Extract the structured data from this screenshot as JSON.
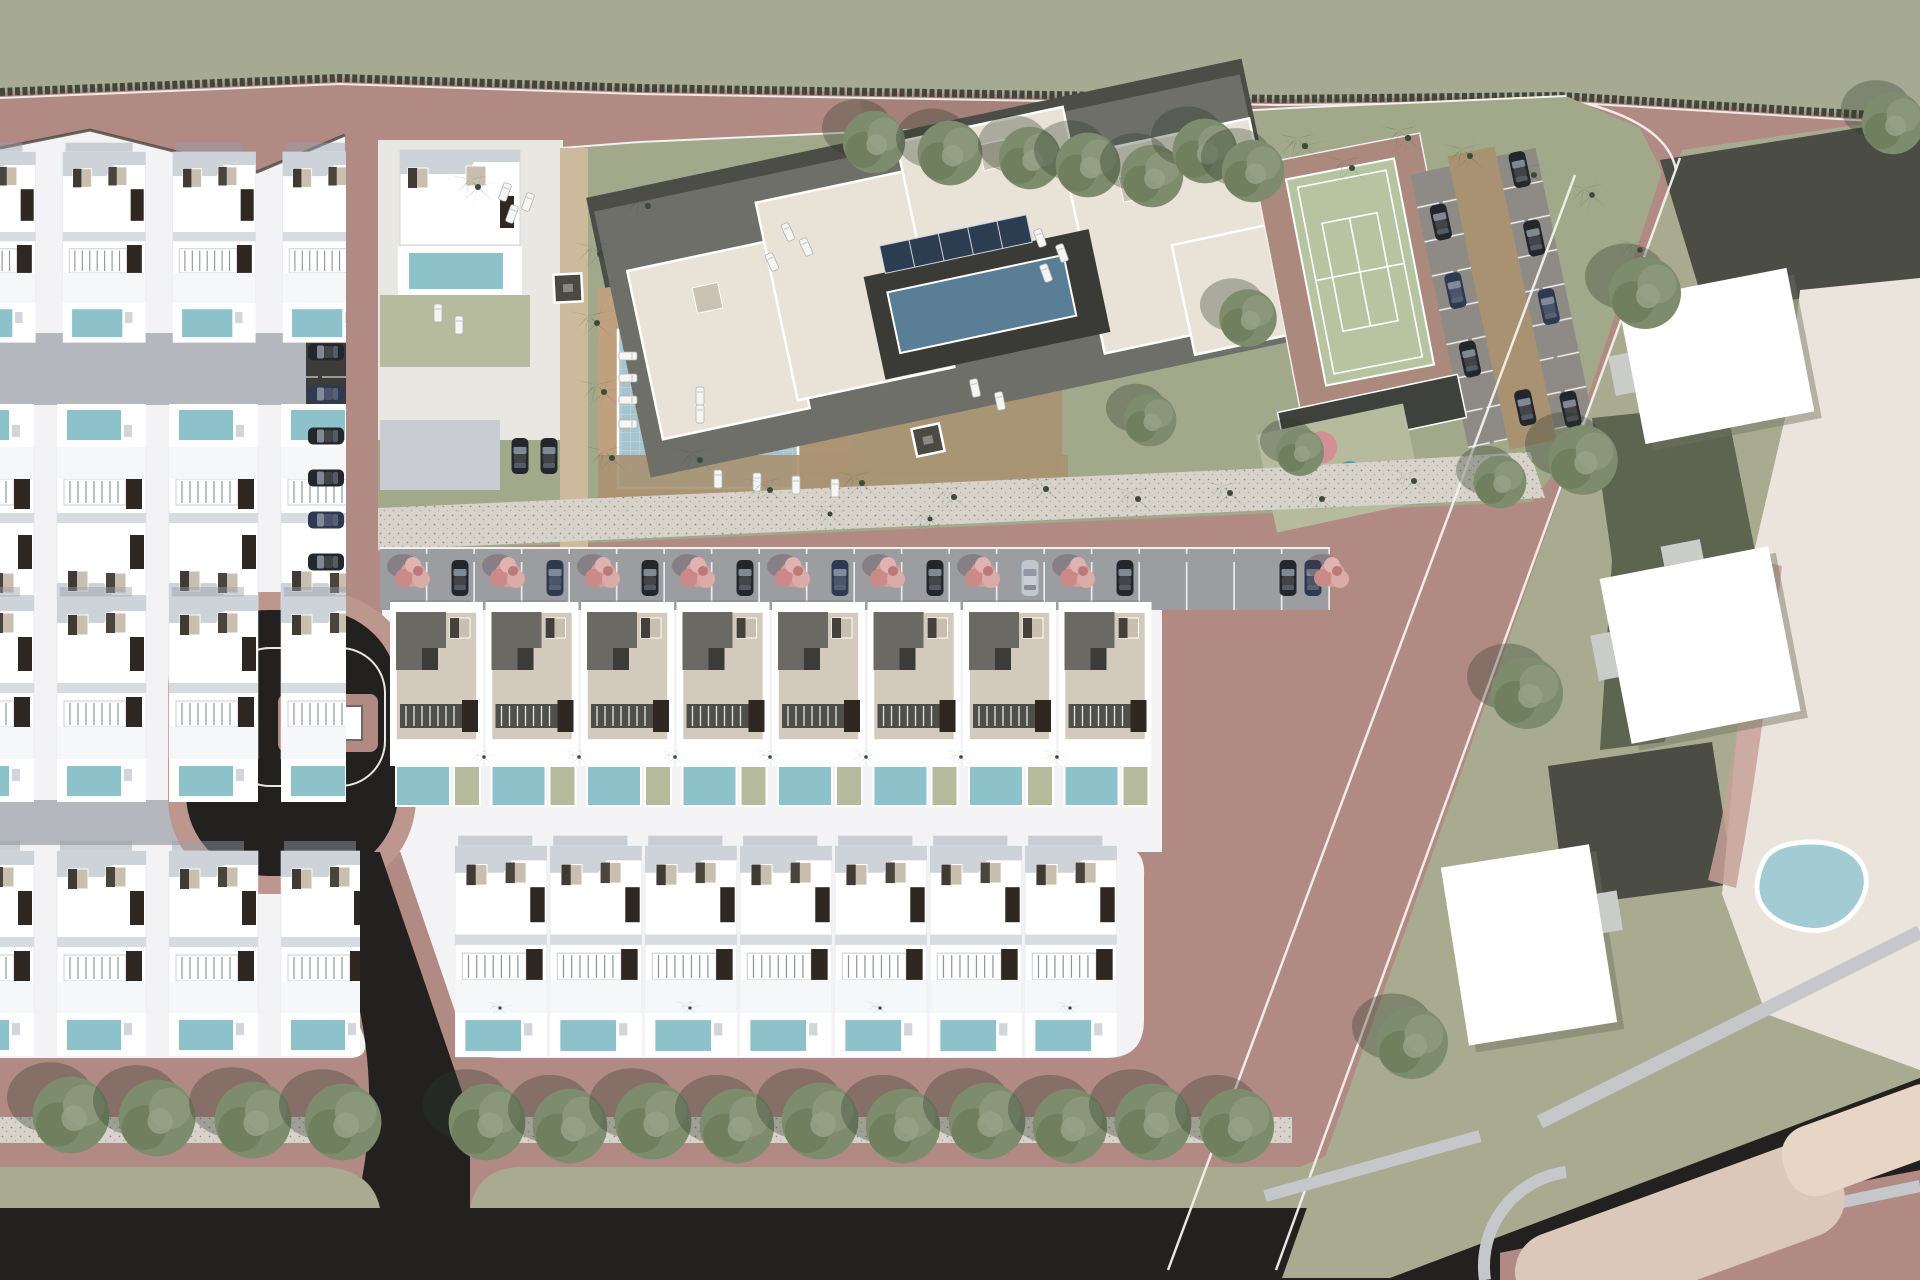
{
  "meta": {
    "title": "Residential development aerial site plan render",
    "render_type": "3D top-down masterplan",
    "visible_text": "none"
  },
  "palette": {
    "road": "#b18a84",
    "road_light": "#bd968e",
    "road_dark": "#a27d77",
    "greenbelt": "#a6aa92",
    "wall": "#41463a",
    "white_ground": "#f3f3f5",
    "driveway": "#b5b7be",
    "sidewalk": "#c6c7cb",
    "asphalt": "#222120",
    "dark_strip": "#3c3d3a",
    "stall_gray": "#8e8b86",
    "lawn_olive": "#a2a88a",
    "lawn_sage": "#a8ab90",
    "lawn_dark": "#5d6450",
    "sage_pad": "#b7bb9e",
    "pool": "#8ec2cb",
    "big_pool": "#a7c4ce",
    "apt_pool": "#5a7e95",
    "pond": "#a3cbd3",
    "deck_tan": "#bfa07f",
    "path_tan": "#a89272",
    "plaza_tan": "#c9b294",
    "gravel": "#d7d3ca",
    "roof_tan": "#d2cbbd",
    "roof_dark": "#5e5e5a",
    "tree": "#7e8c6e",
    "tree_dark": "#5c6b4f",
    "palm": "#57745a",
    "pink_tree": "#d49d9a",
    "car_dark": "#23262a",
    "car_navy": "#2e3952",
    "car_silver": "#c2c7cf",
    "garage_brown": "#2f2721",
    "window_beige": "#c8bfae",
    "cream": "#ebe4dd",
    "beige": "#dbc8ba",
    "dark_drive": "#4b4c44",
    "tennis": "#b7c4a2",
    "tennis_pad": "#ab8a7d",
    "apt_plate": "#6e6f68",
    "apt_dark": "#4c4d47",
    "apt_cream": "#e8e3d6",
    "courtyard": "#3a3b36",
    "solar": "#2c3d52",
    "play_pink": "#d48f96",
    "play_teal": "#4f97a8",
    "play_sand": "#d7b98a"
  },
  "scene": {
    "villa_rows": [
      {
        "x": -50,
        "y": 152,
        "n": 4,
        "dx": 110,
        "v": "a",
        "s": 0.93,
        "clip": "clipL"
      },
      {
        "x": -58,
        "y": 404,
        "n": 4,
        "dx": 112,
        "v": "b",
        "s": 1,
        "clip": "clipL"
      },
      {
        "x": -58,
        "y": 597,
        "n": 4,
        "dx": 112,
        "v": "a",
        "s": 1,
        "clip": "clipL"
      },
      {
        "x": -58,
        "y": 851,
        "n": 4,
        "dx": 112,
        "v": "a",
        "s": 1,
        "clip": "clipL3"
      },
      {
        "x": 452,
        "y": 846,
        "n": 7,
        "dx": 95,
        "v": "a",
        "s": 1.03
      }
    ],
    "townhouses": {
      "x": 388,
      "y": 608,
      "n": 8,
      "dx": 95.5
    },
    "trees": [
      [
        71,
        1115,
        1.6
      ],
      [
        157,
        1118,
        1.6
      ],
      [
        253,
        1120,
        1.6
      ],
      [
        343,
        1122,
        1.6
      ],
      [
        487,
        1122,
        1.6
      ],
      [
        570,
        1126,
        1.55
      ],
      [
        653,
        1121,
        1.6
      ],
      [
        737,
        1126,
        1.55
      ],
      [
        820,
        1121,
        1.6
      ],
      [
        903,
        1126,
        1.55
      ],
      [
        987,
        1121,
        1.6
      ],
      [
        1070,
        1126,
        1.55
      ],
      [
        1153,
        1122,
        1.6
      ],
      [
        1237,
        1126,
        1.55
      ],
      [
        874,
        142,
        1.3
      ],
      [
        950,
        153,
        1.35
      ],
      [
        1030,
        158,
        1.3
      ],
      [
        1088,
        165,
        1.35
      ],
      [
        1152,
        176,
        1.3
      ],
      [
        1205,
        151,
        1.35
      ],
      [
        1253,
        171,
        1.3
      ],
      [
        1645,
        293,
        1.5
      ],
      [
        1583,
        460,
        1.45
      ],
      [
        1527,
        693,
        1.5
      ],
      [
        1412,
        1043,
        1.5
      ],
      [
        1893,
        123,
        1.3
      ],
      [
        1248,
        318,
        1.2
      ],
      [
        1150,
        420,
        1.1
      ],
      [
        1500,
        482,
        1.1
      ],
      [
        1300,
        452,
        1.0
      ]
    ],
    "palms": [
      [
        600,
        254,
        1
      ],
      [
        597,
        323,
        1
      ],
      [
        604,
        392,
        1
      ],
      [
        612,
        458,
        1
      ],
      [
        648,
        206,
        1
      ],
      [
        478,
        187,
        1
      ],
      [
        700,
        460,
        1
      ],
      [
        770,
        490,
        1
      ],
      [
        862,
        483,
        1
      ],
      [
        954,
        497,
        1
      ],
      [
        1046,
        489,
        1
      ],
      [
        1138,
        499,
        1
      ],
      [
        1230,
        493,
        1
      ],
      [
        1322,
        499,
        1
      ],
      [
        1414,
        481,
        1
      ],
      [
        830,
        514,
        0.85
      ],
      [
        930,
        519,
        0.85
      ],
      [
        1305,
        146,
        1.05
      ],
      [
        1352,
        168,
        1
      ],
      [
        1408,
        138,
        1.05
      ],
      [
        1470,
        156,
        1
      ],
      [
        1534,
        175,
        1
      ],
      [
        1592,
        195,
        0.95
      ],
      [
        1640,
        250,
        0.9
      ],
      [
        484,
        757,
        0.6
      ],
      [
        579,
        757,
        0.6
      ],
      [
        675,
        757,
        0.6
      ],
      [
        770,
        757,
        0.6
      ],
      [
        866,
        757,
        0.6
      ],
      [
        961,
        757,
        0.6
      ],
      [
        1057,
        757,
        0.6
      ],
      [
        500,
        1008,
        0.55
      ],
      [
        690,
        1008,
        0.55
      ],
      [
        880,
        1008,
        0.55
      ],
      [
        1070,
        1008,
        0.55
      ]
    ],
    "pink_trees": [
      [
        413,
        574
      ],
      [
        508,
        574
      ],
      [
        603,
        574
      ],
      [
        698,
        574
      ],
      [
        793,
        574
      ],
      [
        888,
        574
      ],
      [
        983,
        574
      ],
      [
        1078,
        574
      ],
      [
        1332,
        574
      ]
    ],
    "cars": [
      {
        "x": 460,
        "y": 578,
        "r": 90,
        "c": "car_dark"
      },
      {
        "x": 555,
        "y": 578,
        "r": 90,
        "c": "car_navy"
      },
      {
        "x": 650,
        "y": 578,
        "r": 90,
        "c": "car_dark"
      },
      {
        "x": 745,
        "y": 578,
        "r": 90,
        "c": "car_dark"
      },
      {
        "x": 840,
        "y": 578,
        "r": 90,
        "c": "car_navy"
      },
      {
        "x": 935,
        "y": 578,
        "r": 90,
        "c": "car_dark"
      },
      {
        "x": 1030,
        "y": 578,
        "r": 90,
        "c": "car_silver"
      },
      {
        "x": 1125,
        "y": 578,
        "r": 90,
        "c": "car_dark"
      },
      {
        "x": 1288,
        "y": 578,
        "r": 90,
        "c": "car_dark"
      },
      {
        "x": 1313,
        "y": 578,
        "r": 90,
        "c": "car_navy"
      },
      {
        "x": 326,
        "y": 352,
        "r": 0,
        "c": "car_dark"
      },
      {
        "x": 326,
        "y": 394,
        "r": 0,
        "c": "car_navy"
      },
      {
        "x": 326,
        "y": 436,
        "r": 0,
        "c": "car_dark"
      },
      {
        "x": 326,
        "y": 478,
        "r": 0,
        "c": "car_dark"
      },
      {
        "x": 326,
        "y": 520,
        "r": 0,
        "c": "car_navy"
      },
      {
        "x": 326,
        "y": 562,
        "r": 0,
        "c": "car_dark"
      },
      {
        "x": 520,
        "y": 456,
        "r": 90,
        "c": "car_dark"
      },
      {
        "x": 549,
        "y": 456,
        "r": 90,
        "c": "car_dark"
      },
      {
        "g": "lot",
        "x": -44,
        "y": -87,
        "r": 90,
        "c": "car_dark"
      },
      {
        "g": "lot",
        "x": -44,
        "y": -17,
        "r": 90,
        "c": "car_navy"
      },
      {
        "g": "lot",
        "x": -44,
        "y": 53,
        "r": 90,
        "c": "car_dark"
      },
      {
        "g": "lot",
        "x": 44,
        "y": -122,
        "r": 90,
        "c": "car_dark"
      },
      {
        "g": "lot",
        "x": 44,
        "y": -52,
        "r": 90,
        "c": "car_dark"
      },
      {
        "g": "lot",
        "x": 44,
        "y": 18,
        "r": 90,
        "c": "car_navy"
      },
      {
        "g": "lot",
        "x": 44,
        "y": 123,
        "r": 90,
        "c": "car_dark"
      },
      {
        "g": "lot",
        "x": 0,
        "y": 112,
        "r": 90,
        "c": "car_dark"
      }
    ],
    "loungers": [
      [
        628,
        356,
        90
      ],
      [
        628,
        378,
        90
      ],
      [
        628,
        400,
        90
      ],
      [
        628,
        424,
        90
      ],
      [
        700,
        396,
        0
      ],
      [
        700,
        414,
        0
      ],
      [
        505,
        192,
        20
      ],
      [
        528,
        202,
        20
      ],
      [
        512,
        214,
        20
      ],
      [
        788,
        232,
        -25
      ],
      [
        806,
        247,
        -25
      ],
      [
        772,
        262,
        -25
      ],
      [
        1040,
        238,
        -20
      ],
      [
        1062,
        253,
        -20
      ],
      [
        1046,
        273,
        -20
      ],
      [
        438,
        313,
        0
      ],
      [
        459,
        325,
        0
      ],
      [
        975,
        388,
        -12
      ],
      [
        1000,
        401,
        -12
      ],
      [
        718,
        479,
        0
      ],
      [
        757,
        482,
        0
      ],
      [
        796,
        485,
        0
      ],
      [
        835,
        488,
        0
      ]
    ],
    "kiosks": [
      [
        568,
        288,
        -3
      ],
      [
        928,
        440,
        -12
      ]
    ]
  },
  "counts": {
    "townhouse_units": 8,
    "bottom_center_villas": 7,
    "left_block_villa_rows": 4,
    "street_trees_bottom": 14,
    "tennis_courts": 1,
    "roundabouts": 1
  }
}
